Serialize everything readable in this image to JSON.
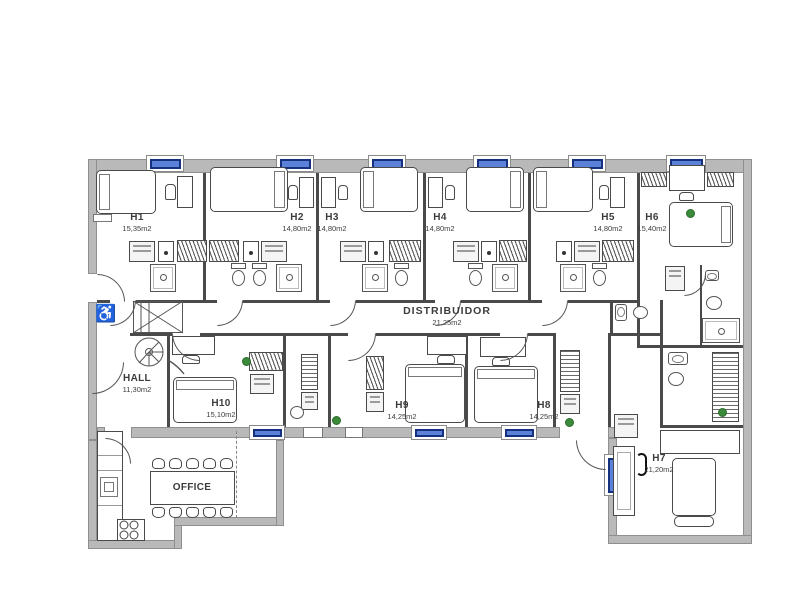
{
  "title": "Residential floor plan with numbered rooms",
  "colors": {
    "wall_gray": "#b9b9b9",
    "window_frame": "#15307c",
    "window_fill": "#5b82d8",
    "accent_green": "#3a8a3a"
  },
  "icons": {
    "accessible": "♿"
  },
  "rooms": [
    {
      "id": "h1",
      "name": "H1",
      "area": "15,35m2"
    },
    {
      "id": "h2",
      "name": "H2",
      "area": "14,80m2"
    },
    {
      "id": "h3",
      "name": "H3",
      "area": "14,80m2"
    },
    {
      "id": "h4",
      "name": "H4",
      "area": "14,80m2"
    },
    {
      "id": "h5",
      "name": "H5",
      "area": "14,80m2"
    },
    {
      "id": "h6",
      "name": "H6",
      "area": "15,40m2"
    },
    {
      "id": "h7",
      "name": "H7",
      "area": "21,20m2"
    },
    {
      "id": "h8",
      "name": "H8",
      "area": "14,25m2"
    },
    {
      "id": "h9",
      "name": "H9",
      "area": "14,25m2"
    },
    {
      "id": "h10",
      "name": "H10",
      "area": "15,10m2"
    },
    {
      "id": "hall",
      "name": "HALL",
      "area": "11,30m2"
    },
    {
      "id": "distribuidor",
      "name": "DISTRIBUIDOR",
      "area": "21,25m2"
    },
    {
      "id": "office",
      "name": "OFFICE",
      "area": ""
    }
  ]
}
